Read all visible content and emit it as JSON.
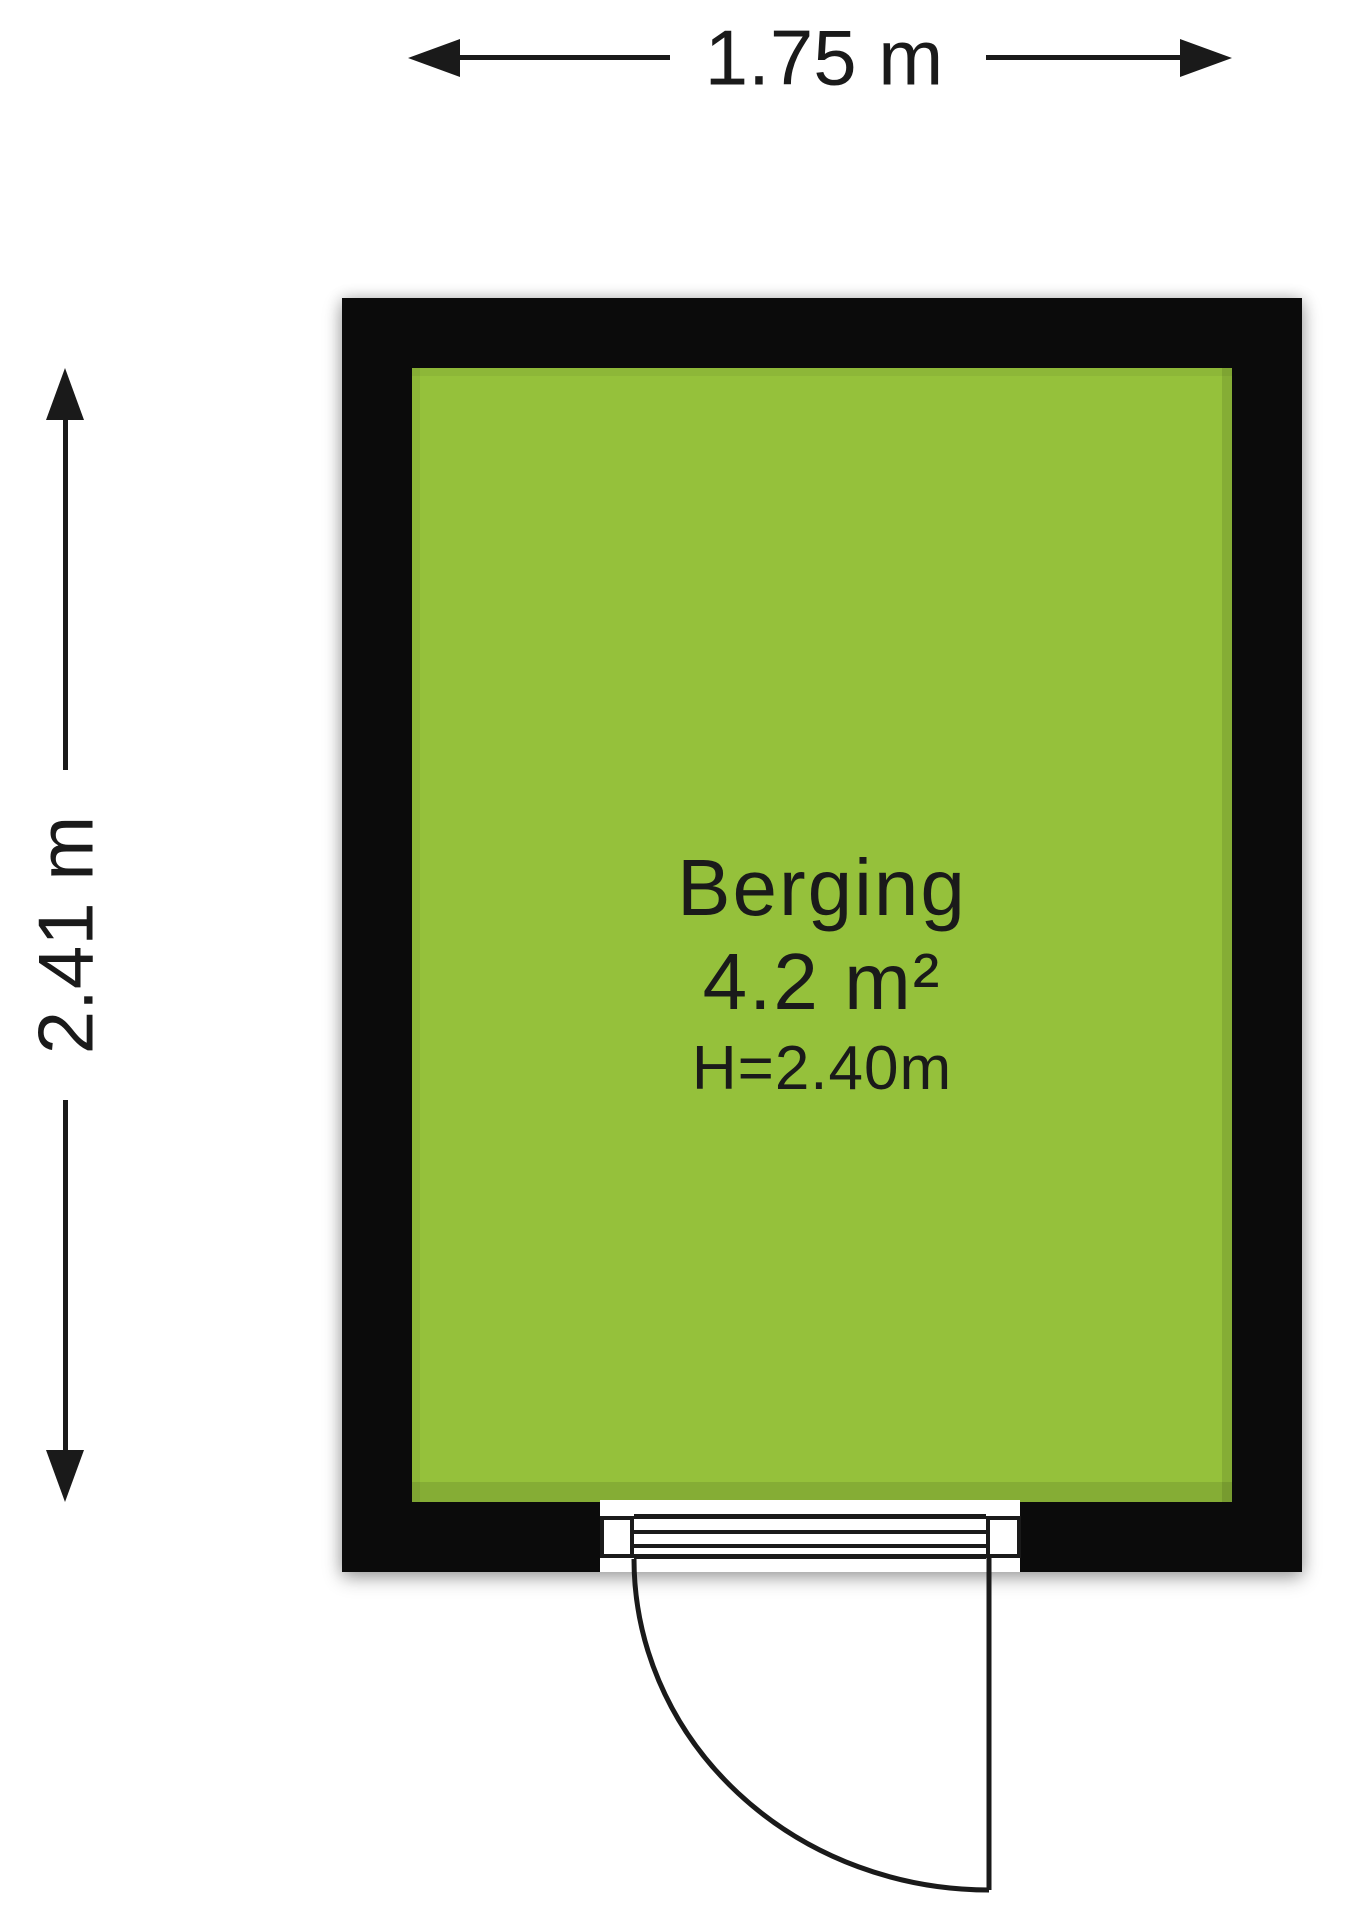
{
  "plan": {
    "width_dimension": "1.75 m",
    "height_dimension": "2.41 m",
    "room": {
      "name": "Berging",
      "area": "4.2 m²",
      "ceiling_height": "H=2.40m"
    }
  },
  "colors": {
    "floor": "#95c13b",
    "wall": "#0b0b0b",
    "line": "#1a1a1a"
  }
}
